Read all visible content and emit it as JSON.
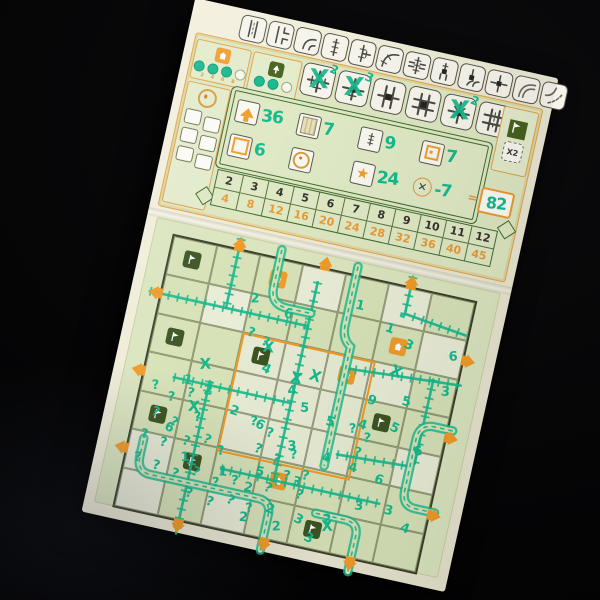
{
  "palette": {
    "teal": "#15b98d",
    "orange": "#ef9d2c",
    "dark_green": "#3c5422",
    "panel_green": "#dbe5bf",
    "ink": "#4a4a45"
  },
  "top_panel": {
    "reference_tiles": [
      "road-straight",
      "road-tee",
      "road-curve",
      "rail-straight",
      "rail-tee",
      "rail-curve",
      "overpass",
      "station-straight",
      "station-curve",
      "station-tee",
      "river-curve",
      "lake-corner"
    ],
    "station_tracker": {
      "icon": "station-icon",
      "dots_total": 4,
      "dots_filled": 3,
      "labels": [
        "2",
        "4",
        "6",
        "8"
      ]
    },
    "forest_tracker": {
      "icon": "forest-icon",
      "dots_total": 3,
      "dots_filled": 2
    },
    "special_tiles": [
      {
        "name": "special-rail-cross",
        "used": true,
        "mark": "2"
      },
      {
        "name": "special-station-cross",
        "used": true,
        "mark": "3"
      },
      {
        "name": "special-road-rail-cross",
        "used": false,
        "mark": ""
      },
      {
        "name": "special-station-plus",
        "used": false,
        "mark": ""
      },
      {
        "name": "special-rail-plus",
        "used": true,
        "mark": "2"
      },
      {
        "name": "special-road-cross",
        "used": false,
        "mark": ""
      }
    ],
    "bonus_box": {
      "flag_icon": "flag-icon",
      "multiplier_label": "X2"
    },
    "round_tracker": {
      "icon": "bullseye-icon",
      "boxes": 6
    },
    "score_row_1": [
      {
        "icon": "exits-arrow-icon",
        "value": "36"
      },
      {
        "icon": "longest-road-icon",
        "value": "7"
      },
      {
        "icon": "longest-rail-icon",
        "value": "9"
      },
      {
        "icon": "center-squares-icon",
        "value": "7"
      }
    ],
    "score_row_2": [
      {
        "icon": "square-icon",
        "value": "6"
      },
      {
        "icon": "bullseye-icon",
        "value": ""
      },
      {
        "icon": "star-icon",
        "value": "24"
      },
      {
        "icon": "errors-icon",
        "value": "-7"
      }
    ],
    "equals_sign": "=",
    "total_score": "82",
    "exit_table": {
      "top_row": [
        "2",
        "3",
        "4",
        "5",
        "6",
        "7",
        "8",
        "9",
        "10",
        "11",
        "12"
      ],
      "bottom_row": [
        "4",
        "8",
        "12",
        "16",
        "20",
        "24",
        "28",
        "32",
        "36",
        "40",
        "45"
      ]
    }
  },
  "grid": {
    "rows": 7,
    "cols": 7,
    "exits": {
      "top_cols": [
        1,
        3,
        5
      ],
      "bottom_cols": [
        1,
        3,
        5
      ],
      "left_rows": [
        1,
        3,
        5
      ],
      "right_rows": [
        1,
        3,
        5
      ]
    },
    "center": {
      "row": 2,
      "col": 2,
      "span": 3
    },
    "green_cells": [
      [
        0,
        0
      ],
      [
        2,
        0
      ],
      [
        4,
        0
      ],
      [
        2,
        2
      ],
      [
        3,
        5
      ],
      [
        5,
        1
      ],
      [
        6,
        4
      ]
    ],
    "orange_cells": [
      [
        0,
        2
      ],
      [
        1,
        5
      ],
      [
        2,
        4
      ],
      [
        5,
        3
      ]
    ],
    "light_cells": [
      [
        0,
        3
      ],
      [
        1,
        1
      ],
      [
        3,
        3
      ],
      [
        2,
        5
      ],
      [
        5,
        0
      ],
      [
        6,
        2
      ],
      [
        0,
        5
      ],
      [
        4,
        6
      ],
      [
        6,
        0
      ],
      [
        1,
        6
      ]
    ],
    "routes": [
      {
        "type": "rail",
        "d": "M-12 59 L150 59"
      },
      {
        "type": "rail",
        "d": "M150 14 L150 218"
      },
      {
        "type": "rail",
        "d": "M66 -12 L66 59"
      },
      {
        "type": "rail",
        "d": "M242 -12 L242 26 L306 34"
      },
      {
        "type": "rail",
        "d": "M196 92 L312 84"
      },
      {
        "type": "rail",
        "d": "M30 138 L150 138"
      },
      {
        "type": "rail",
        "d": "M66 134 L66 290"
      },
      {
        "type": "rail",
        "d": "M96 217 L258 217"
      },
      {
        "type": "rail",
        "d": "M284 84 L284 170"
      },
      {
        "type": "rail",
        "d": "M206 178 L280 174"
      },
      {
        "type": "road",
        "d": "M186 -10 L186 50 Q186 64 196 70 L196 192"
      },
      {
        "type": "road",
        "d": "M108 -10 L108 28 Q108 46 126 46 L150 46"
      },
      {
        "type": "road",
        "d": "M314 130 L296 130 Q280 130 280 146 L280 198 Q280 214 294 214 L314 214"
      },
      {
        "type": "road",
        "d": "M152 288 L152 252 Q152 238 138 238 L28 238 Q14 238 14 222 L14 204"
      },
      {
        "type": "road",
        "d": "M198 240 L228 240 Q242 240 242 254 L242 290"
      }
    ],
    "numbers": [
      {
        "x": 92,
        "y": 44,
        "t": "2"
      },
      {
        "x": 128,
        "y": 52,
        "t": "6"
      },
      {
        "x": 196,
        "y": 28,
        "t": "1"
      },
      {
        "x": 230,
        "y": 44,
        "t": "1"
      },
      {
        "x": 252,
        "y": 56,
        "t": "3"
      },
      {
        "x": 298,
        "y": 58,
        "t": "6"
      },
      {
        "x": 298,
        "y": 94,
        "t": "3"
      },
      {
        "x": 262,
        "y": 112,
        "t": "5"
      },
      {
        "x": 228,
        "y": 118,
        "t": "9"
      },
      {
        "x": 118,
        "y": 110,
        "t": "4"
      },
      {
        "x": 148,
        "y": 126,
        "t": "4"
      },
      {
        "x": 164,
        "y": 140,
        "t": "5"
      },
      {
        "x": 192,
        "y": 148,
        "t": "5"
      },
      {
        "x": 224,
        "y": 144,
        "t": "4"
      },
      {
        "x": 256,
        "y": 140,
        "t": "5"
      },
      {
        "x": 284,
        "y": 158,
        "t": "6"
      },
      {
        "x": 66,
        "y": 144,
        "t": "2"
      },
      {
        "x": 44,
        "y": 138,
        "t": "1"
      },
      {
        "x": 96,
        "y": 158,
        "t": "2"
      },
      {
        "x": 124,
        "y": 166,
        "t": "6"
      },
      {
        "x": 160,
        "y": 180,
        "t": "3"
      },
      {
        "x": 196,
        "y": 184,
        "t": "4"
      },
      {
        "x": 224,
        "y": 188,
        "t": "4"
      },
      {
        "x": 252,
        "y": 194,
        "t": "6"
      },
      {
        "x": 36,
        "y": 188,
        "t": "6"
      },
      {
        "x": 58,
        "y": 214,
        "t": "1"
      },
      {
        "x": 98,
        "y": 220,
        "t": "1"
      },
      {
        "x": 126,
        "y": 230,
        "t": "2"
      },
      {
        "x": 152,
        "y": 246,
        "t": "2"
      },
      {
        "x": 182,
        "y": 250,
        "t": "3"
      },
      {
        "x": 210,
        "y": 244,
        "t": "2"
      },
      {
        "x": 238,
        "y": 224,
        "t": "3"
      },
      {
        "x": 268,
        "y": 222,
        "t": "3"
      },
      {
        "x": 288,
        "y": 236,
        "t": "4"
      },
      {
        "x": 196,
        "y": 266,
        "t": "3"
      },
      {
        "x": 162,
        "y": 262,
        "t": "2"
      },
      {
        "x": 128,
        "y": 260,
        "t": "2"
      },
      {
        "x": 134,
        "y": 212,
        "t": "5"
      },
      {
        "x": 172,
        "y": 214,
        "t": "3"
      }
    ],
    "question_marks": [
      {
        "x": 14,
        "y": 150
      },
      {
        "x": 32,
        "y": 158
      },
      {
        "x": 50,
        "y": 150
      },
      {
        "x": 20,
        "y": 176
      },
      {
        "x": 40,
        "y": 182
      },
      {
        "x": 62,
        "y": 172
      },
      {
        "x": 14,
        "y": 200
      },
      {
        "x": 34,
        "y": 204
      },
      {
        "x": 56,
        "y": 198
      },
      {
        "x": 76,
        "y": 192
      },
      {
        "x": 92,
        "y": 200
      },
      {
        "x": 12,
        "y": 224
      },
      {
        "x": 32,
        "y": 228
      },
      {
        "x": 52,
        "y": 232
      },
      {
        "x": 72,
        "y": 226
      },
      {
        "x": 94,
        "y": 232
      },
      {
        "x": 112,
        "y": 226
      },
      {
        "x": 70,
        "y": 248
      },
      {
        "x": 92,
        "y": 252
      },
      {
        "x": 112,
        "y": 246
      },
      {
        "x": 132,
        "y": 250
      },
      {
        "x": 118,
        "y": 164
      },
      {
        "x": 136,
        "y": 172
      },
      {
        "x": 128,
        "y": 190
      },
      {
        "x": 148,
        "y": 196
      },
      {
        "x": 164,
        "y": 188
      },
      {
        "x": 162,
        "y": 210
      },
      {
        "x": 180,
        "y": 206
      },
      {
        "x": 178,
        "y": 226
      },
      {
        "x": 146,
        "y": 226
      },
      {
        "x": 216,
        "y": 150
      },
      {
        "x": 232,
        "y": 156
      },
      {
        "x": 226,
        "y": 172
      },
      {
        "x": 96,
        "y": 78
      },
      {
        "x": 112,
        "y": 84
      }
    ],
    "x_marks": [
      {
        "x": 58,
        "y": 118
      },
      {
        "x": 116,
        "y": 88
      },
      {
        "x": 150,
        "y": 112
      },
      {
        "x": 168,
        "y": 106
      },
      {
        "x": 246,
        "y": 84
      },
      {
        "x": 212,
        "y": 250
      },
      {
        "x": 56,
        "y": 162
      }
    ],
    "question_glyph": "?",
    "x_glyph": "X"
  }
}
